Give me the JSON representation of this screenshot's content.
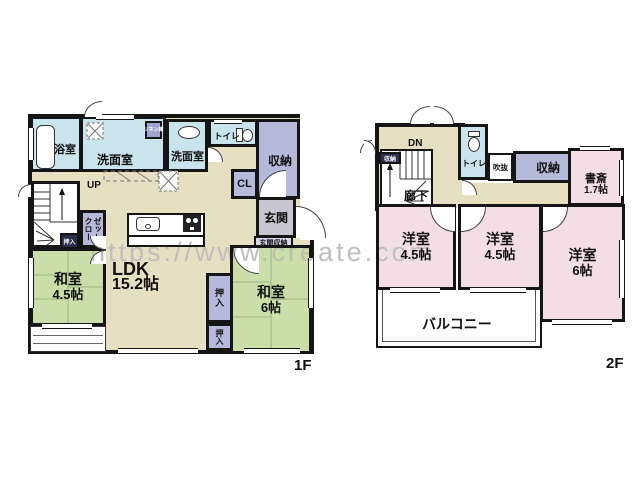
{
  "watermark": "https://www.create.com",
  "colors": {
    "wall": "#151515",
    "ldk_hall_beige": "#E7DFC2",
    "washitsu_green": "#CBDDA9",
    "youshitsu_pink": "#F3DEE6",
    "wet_area_blue": "#C9E4EC",
    "storage_purple": "#B7B9DA",
    "entrance_gray": "#C7C6CE",
    "watermark_gray": "#bfbfbf"
  },
  "floor1": {
    "floor_label": "1F",
    "bath": "浴室",
    "washroom_left": "洗面室",
    "washroom_right": "洗面室",
    "linen": "リネン庫",
    "toilet": "トイレ",
    "storage": "収納",
    "closet_cl": "CL",
    "entrance": "玄関",
    "entrance_storage": "玄関収納",
    "stairs_up": "UP",
    "oshiire_stairs": "押入",
    "closet": "クローゼット",
    "washitsu_small": {
      "name": "和室",
      "size": "4.5帖"
    },
    "ldk": {
      "name": "LDK",
      "size": "15.2帖"
    },
    "oshiire_upper": "押入",
    "oshiire_lower": "押入",
    "washitsu_large": {
      "name": "和室",
      "size": "6帖"
    }
  },
  "floor2": {
    "floor_label": "2F",
    "stairs_down": "DN",
    "storage_stairs": "収納",
    "toilet": "トイレ",
    "void": "吹抜",
    "storage": "収納",
    "study": {
      "name": "書斎",
      "size": "1.7帖"
    },
    "corridor": "廊下",
    "western_left": {
      "name": "洋室",
      "size": "4.5帖"
    },
    "western_middle": {
      "name": "洋室",
      "size": "4.5帖"
    },
    "western_right": {
      "name": "洋室",
      "size": "6帖"
    },
    "balcony": "バルコニー"
  }
}
